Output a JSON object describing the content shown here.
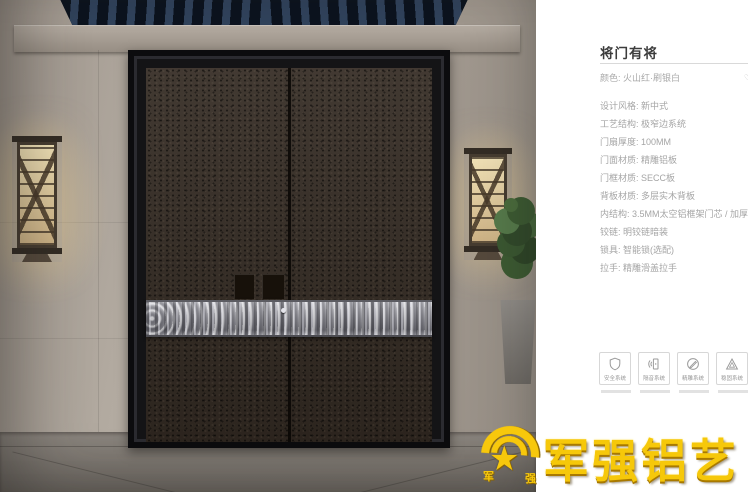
{
  "panel": {
    "title": "将门有将",
    "color_label": "颜色: 火山红·刷银白",
    "model_label": "型号: JC",
    "specs": [
      "设计风格: 新中式",
      "工艺结构: 极窄边系统",
      "门扇厚度: 100MM",
      "门面材质: 精雕铝板",
      "门框材质: SECC板",
      "背板材质: 多层实木背板",
      "内结构: 3.5MM太空铝框架门芯 / 加厚加密航空铝蜂",
      "铰链: 明铰链暗装",
      "锁具: 智能锁(选配)",
      "拉手: 精雕滑盖拉手"
    ],
    "features": [
      {
        "icon": "shield-icon",
        "label": "安全系统"
      },
      {
        "icon": "soundproof-icon",
        "label": "隔音系统"
      },
      {
        "icon": "carving-icon",
        "label": "精雕系统"
      },
      {
        "icon": "stability-icon",
        "label": "稳固系统"
      }
    ]
  },
  "logo": {
    "brand": "军强铝艺",
    "emblem_left_char": "军",
    "emblem_right_char": "强"
  },
  "colors": {
    "brand_gold": "#f6c80a",
    "title_text": "#3c3c3c",
    "spec_text": "#a5a5a5",
    "door_surface": "#362d25",
    "door_frame": "#141416",
    "silver_band": "#a9a9af",
    "ceiling_navy": "#0e1520",
    "wall_stone": "#a89f95",
    "lamp_glow": "#f0e1b6"
  }
}
